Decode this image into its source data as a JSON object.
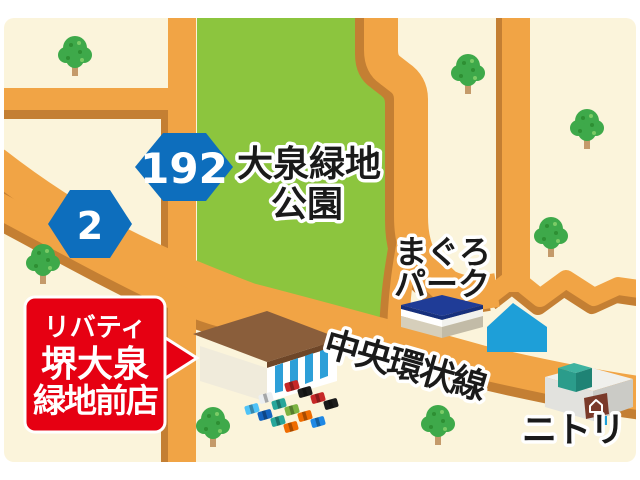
{
  "map": {
    "park": {
      "name_line1": "大泉緑地",
      "name_line2": "公園"
    },
    "landmarks": {
      "maguro_line1": "まぐろ",
      "maguro_line2": "パーク",
      "nitori": "ニトリ"
    },
    "roads": {
      "main_road_name": "中央環状線"
    },
    "route_shields": [
      {
        "number": "192"
      },
      {
        "number": "2"
      }
    ],
    "store_callout": {
      "line1": "リバティ",
      "line2": "堺大泉",
      "line3": "緑地前店"
    },
    "parking": {
      "car_colors": [
        "#C62828",
        "#1B1B1B",
        "#C62828",
        "#1B1B1B",
        "#ECEFF1",
        "#26A69A",
        "#7CB342",
        "#EF6C00",
        "#1E88E5",
        "#4FC3F7",
        "#1565C0",
        "#26A69A",
        "#EF6C00"
      ]
    },
    "colors": {
      "margin_white": "#FFFFFF",
      "background_cream": "#FBF4DB",
      "road_orange": "#F1A445",
      "road_shadow_brown": "#C47F33",
      "park_green": "#8CC53E",
      "shield_blue": "#0D6EBD",
      "callout_red": "#E60012",
      "tree_green": "#3EA94A",
      "store_roof_brown": "#8A5E3B",
      "store_stripe_blue": "#2D9FD8",
      "maguro_roof_navy": "#1F3C97",
      "house_blue": "#1E9FD8",
      "nitori_teal": "#2FA390"
    }
  }
}
